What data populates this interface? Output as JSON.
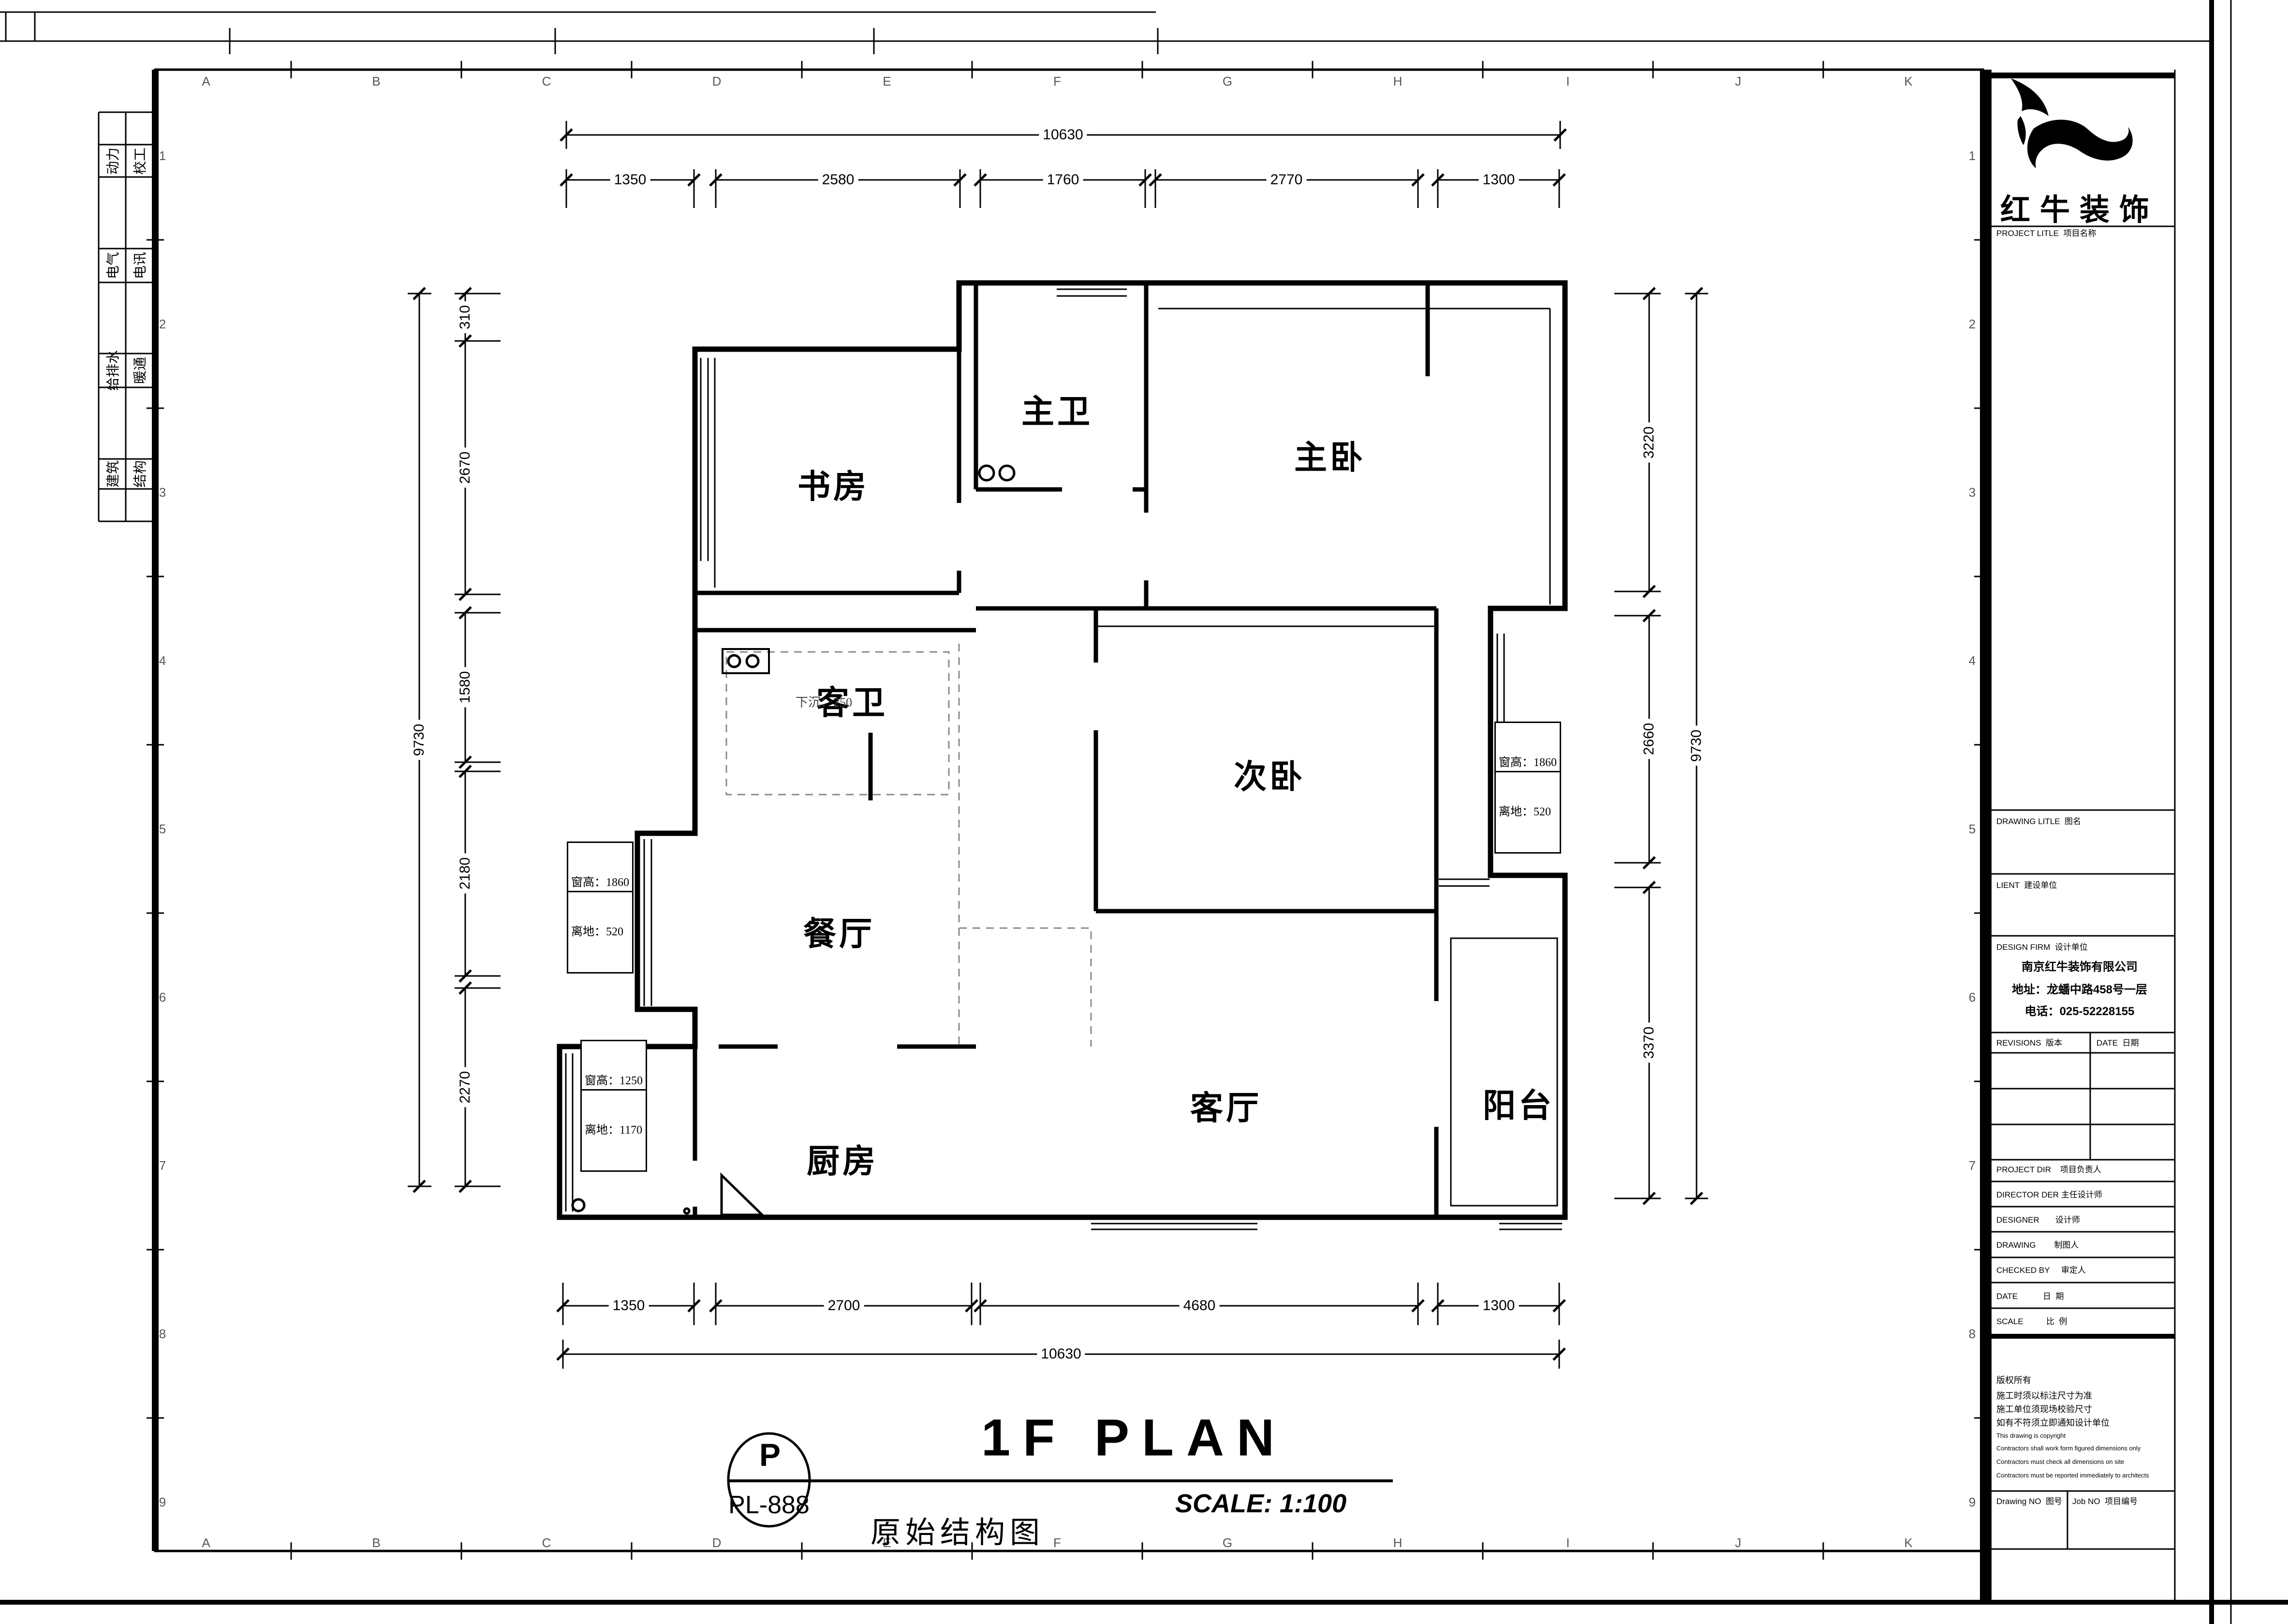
{
  "sheet": {
    "title_en": "1F PLAN",
    "title_cn": "原始结构图",
    "scale": "SCALE: 1:100",
    "tag_letter": "P",
    "tag_code": "PL-888"
  },
  "brand": {
    "name": "红牛装饰"
  },
  "titleblock": {
    "project_title": "PROJECT LITLE  项目名称",
    "drawing_title": "DRAWING LITLE  图名",
    "client": "LIENT  建设单位",
    "design_firm": "DESIGN FIRM  设计单位",
    "firm_name": "南京红牛装饰有限公司",
    "firm_address": "地址：龙蟠中路458号一层",
    "firm_phone": "电话：025-52228155",
    "revisions": "REVISIONS  版本",
    "date_col": "DATE  日期",
    "project_dir": "PROJECT DIR    项目负责人",
    "director": "DIRECTOR DER 主任设计师",
    "designer": "DESIGNER       设计师",
    "drawing_by": "DRAWING        制图人",
    "checked_by": "CHECKED BY     审定人",
    "date_row": "DATE           日  期",
    "scale_row": "SCALE          比  例",
    "copyright_cn": [
      "版权所有",
      "施工时须以标注尺寸为准",
      "施工单位须现场校验尺寸",
      "如有不符须立即通知设计单位"
    ],
    "copyright_en": [
      "This drawing is copyright",
      "Contractors shall work form figured dimensions only",
      "Contractors must check all dimensions on site",
      "Contractors must be reported immediately to architects"
    ],
    "drawing_no": "Drawing NO  图号",
    "job_no": "Job NO  项目编号"
  },
  "strip": {
    "rows": [
      [
        "动力",
        "校工"
      ],
      [
        "电气",
        "电讯"
      ],
      [
        "给排水",
        "暖通"
      ],
      [
        "建筑",
        "结构"
      ]
    ]
  },
  "grid": {
    "cols": [
      "A",
      "B",
      "C",
      "D",
      "E",
      "F",
      "G",
      "H",
      "I",
      "J",
      "K"
    ],
    "rows": [
      "1",
      "2",
      "3",
      "4",
      "5",
      "6",
      "7",
      "8",
      "9"
    ]
  },
  "rooms": [
    "书房",
    "主卫",
    "主卧",
    "客卫",
    "次卧",
    "餐厅",
    "厨房",
    "客厅",
    "阳台"
  ],
  "dims": {
    "top_total": "10630",
    "top": [
      "1350",
      "2580",
      "1760",
      "2770",
      "1300"
    ],
    "bottom": [
      "1350",
      "2700",
      "4680",
      "1300"
    ],
    "bottom_total": "10630",
    "left_total": "9730",
    "left": [
      "310",
      "2670",
      "1580",
      "2180",
      "2270"
    ],
    "right": [
      "3220",
      "2660",
      "3370"
    ],
    "right_total": "9730"
  },
  "notes": {
    "sunken": "下沉：250",
    "win_left": [
      "窗高：1860",
      "离地：520"
    ],
    "win_right": [
      "窗高：1860",
      "离地：520"
    ],
    "win_kitchen": [
      "窗高：1250",
      "离地：1170"
    ]
  }
}
